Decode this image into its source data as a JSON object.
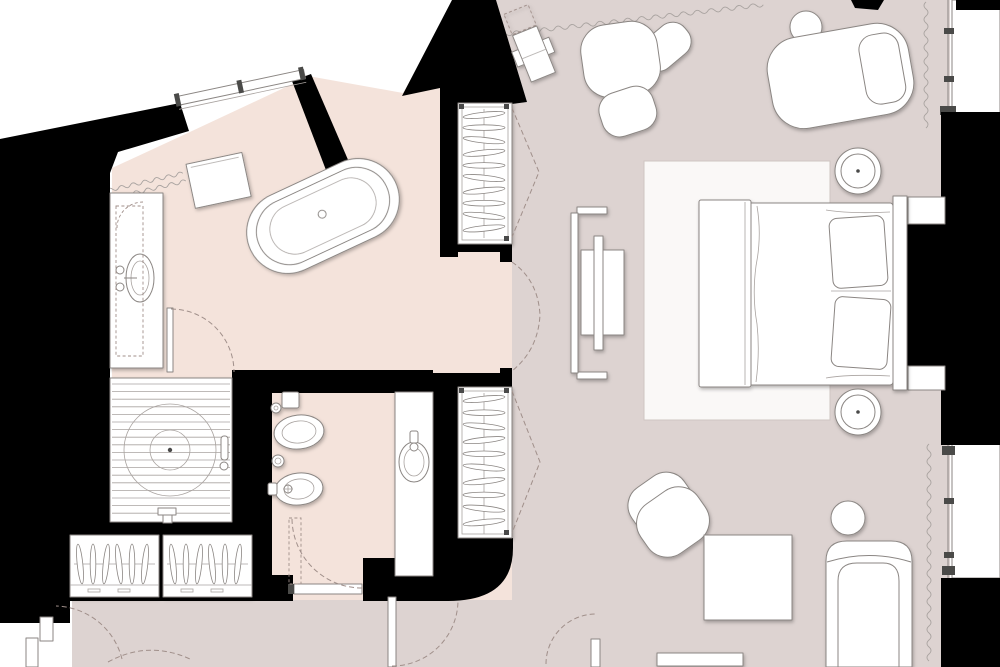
{
  "title": "Hotel suite floor plan",
  "colors": {
    "outside": "#ffffff",
    "wall": "#000000",
    "bathroom_floor": "#f4e3db",
    "bedroom_floor": "#ddd3d1",
    "fixture_fill": "#ffffff",
    "fixture_stroke": "#8b8683",
    "detail_stroke": "#a9a3a0",
    "dark_detail": "#4a4a48",
    "dash_stroke": "#a08f8a",
    "rug_fill": "#faf8f7",
    "rug_stroke": "#cfc6c2",
    "glass": "#ffffff"
  },
  "rooms": [
    {
      "name": "bathroom"
    },
    {
      "name": "wc"
    },
    {
      "name": "dressing-corridor"
    },
    {
      "name": "bedroom"
    },
    {
      "name": "entry-corridor"
    }
  ],
  "fixtures": [
    "vanity-sink",
    "freestanding-bathtub",
    "walk-in-shower",
    "towel-radiator",
    "window-bench",
    "toilet",
    "bidet",
    "wc-vanity-sink"
  ],
  "furniture": [
    "upper-wardrobe",
    "lower-wardrobe",
    "dresser-wardrobes",
    "king-bed",
    "headboard",
    "nightstand",
    "area-rug",
    "tv-console",
    "armchair",
    "ottoman",
    "chaise-longue",
    "round-side-table",
    "tub-chair",
    "square-side-table",
    "sofa",
    "round-pillow",
    "luggage-rack",
    "coffee-table"
  ],
  "openings": [
    "bathroom-window",
    "bedroom-window-north",
    "bedroom-window-east-upper",
    "bedroom-window-east-lower",
    "wc-door",
    "bathroom-inner-door",
    "passage-double-door",
    "entry-door",
    "terrace-door",
    "corner-entry-door"
  ]
}
